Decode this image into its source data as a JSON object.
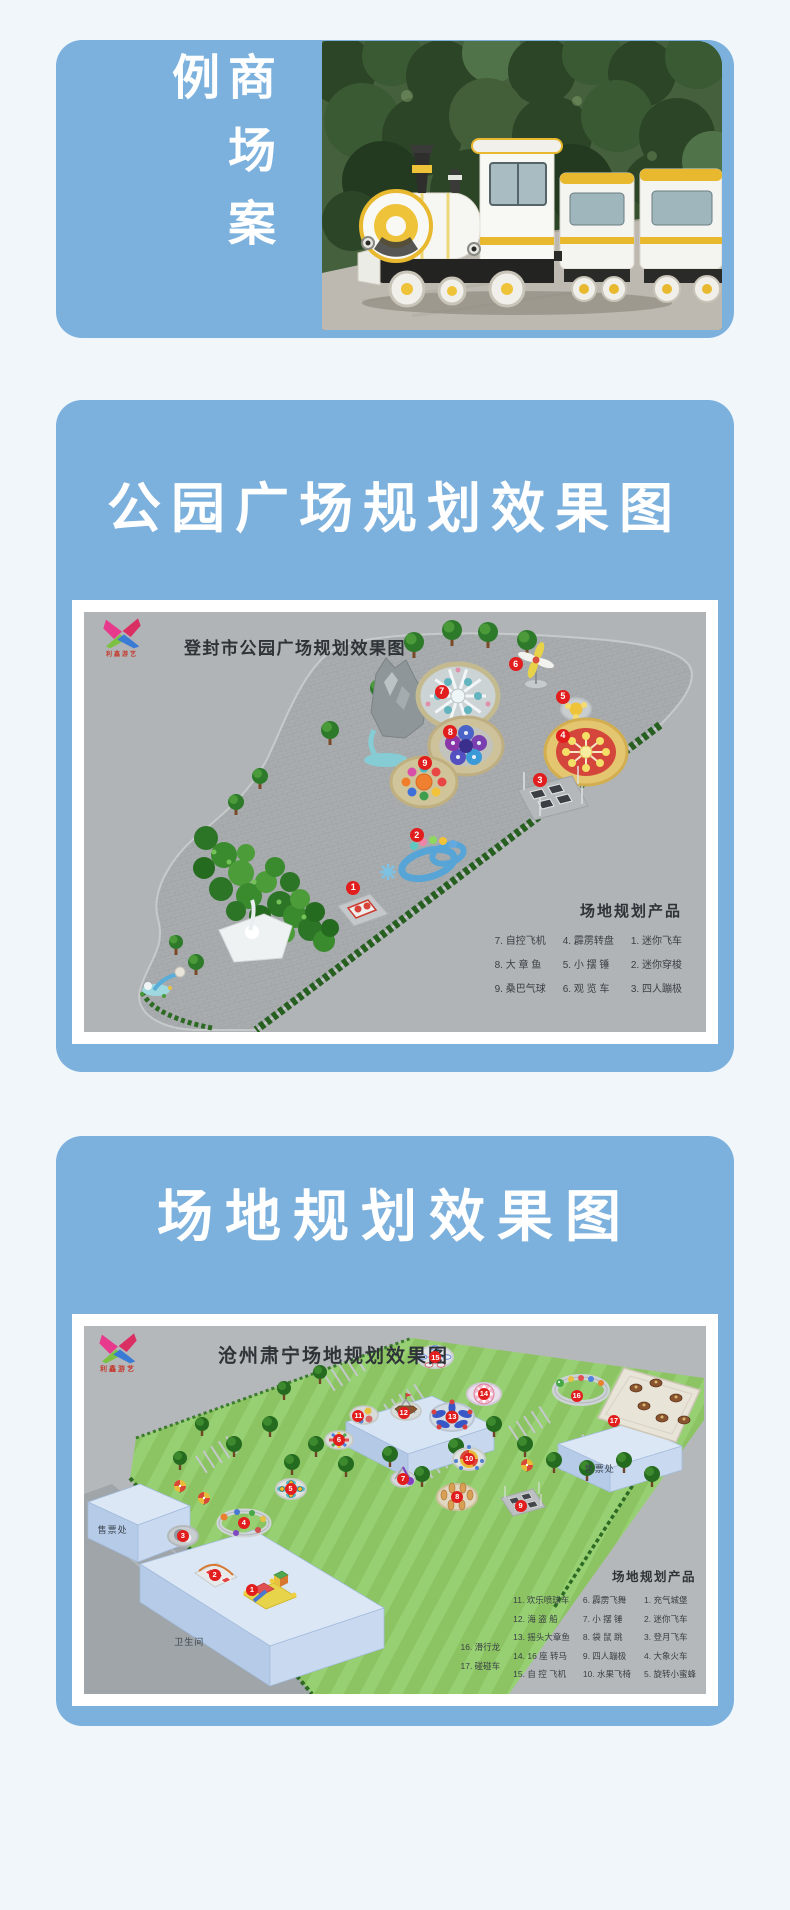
{
  "colors": {
    "page_bg": "#f0f6fa",
    "card_blue": "#7db1dd",
    "marker_red": "#e11d1d"
  },
  "mall_case": {
    "title": "商场案例",
    "photo": "trackless-sightseeing-train"
  },
  "park_section": {
    "title": "公园广场规划效果图",
    "plan": {
      "logo_text": "利鑫游艺",
      "title": "登封市公园广场规划效果图",
      "legend": {
        "title": "场地规划产品",
        "columns": [
          [
            "7. 自控飞机",
            "8. 大 章 鱼",
            "9. 桑巴气球"
          ],
          [
            "4. 霹雳转盘",
            "5. 小 摆 锤",
            "6. 观 览 车"
          ],
          [
            "1. 迷你飞车",
            "2. 迷你穿梭",
            "3. 四人蹦极"
          ]
        ]
      },
      "markers": [
        {
          "n": "1",
          "x": 43.3,
          "y": 65.7
        },
        {
          "n": "2",
          "x": 53.5,
          "y": 53.1
        },
        {
          "n": "3",
          "x": 73.3,
          "y": 40
        },
        {
          "n": "4",
          "x": 77,
          "y": 29.5
        },
        {
          "n": "5",
          "x": 77,
          "y": 20.2
        },
        {
          "n": "6",
          "x": 69.4,
          "y": 12.4
        },
        {
          "n": "7",
          "x": 57.5,
          "y": 19
        },
        {
          "n": "8",
          "x": 58.9,
          "y": 28.6
        },
        {
          "n": "9",
          "x": 54.8,
          "y": 36
        }
      ]
    }
  },
  "site_section": {
    "title": "场地规划效果图",
    "plan": {
      "logo_text": "利鑫游艺",
      "title": "沧州肃宁场地规划效果图",
      "labels": {
        "ticket_left": "售票处",
        "ticket_right": "售票处",
        "restroom": "卫生间"
      },
      "legend": {
        "title": "场地规划产品",
        "columns": [
          [
            "16. 滑行龙",
            "17. 碰碰车"
          ],
          [
            "11. 欢乐喷球车",
            "12. 海 盗 船",
            "13. 摇头大章鱼",
            "14. 16 座 转马",
            "15. 自 控 飞机"
          ],
          [
            "6. 霹雳飞舞",
            "7. 小 摆 锤",
            "8. 袋 鼠 跳",
            "9. 四人蹦极",
            "10. 水果飞椅"
          ],
          [
            "1. 充气城堡",
            "2. 迷你飞车",
            "3. 登月飞车",
            "4. 大象火车",
            "5. 旋转小蜜蜂"
          ]
        ]
      },
      "markers": [
        {
          "n": "1",
          "x": 27,
          "y": 71.7
        },
        {
          "n": "2",
          "x": 21,
          "y": 67.7
        },
        {
          "n": "3",
          "x": 15.9,
          "y": 57.1
        },
        {
          "n": "4",
          "x": 25.7,
          "y": 53.5
        },
        {
          "n": "5",
          "x": 33.2,
          "y": 44.3
        },
        {
          "n": "6",
          "x": 41,
          "y": 31
        },
        {
          "n": "7",
          "x": 51.3,
          "y": 41.6
        },
        {
          "n": "8",
          "x": 60,
          "y": 46.5
        },
        {
          "n": "9",
          "x": 70.2,
          "y": 48.9
        },
        {
          "n": "10",
          "x": 61.9,
          "y": 36.1
        },
        {
          "n": "11",
          "x": 44.1,
          "y": 24.5
        },
        {
          "n": "12",
          "x": 51.4,
          "y": 23.6
        },
        {
          "n": "13",
          "x": 59.2,
          "y": 24.7
        },
        {
          "n": "14",
          "x": 64.3,
          "y": 18.5
        },
        {
          "n": "15",
          "x": 56.5,
          "y": 8.5
        },
        {
          "n": "16",
          "x": 79.2,
          "y": 19
        },
        {
          "n": "17",
          "x": 85.2,
          "y": 25.8
        }
      ]
    }
  }
}
